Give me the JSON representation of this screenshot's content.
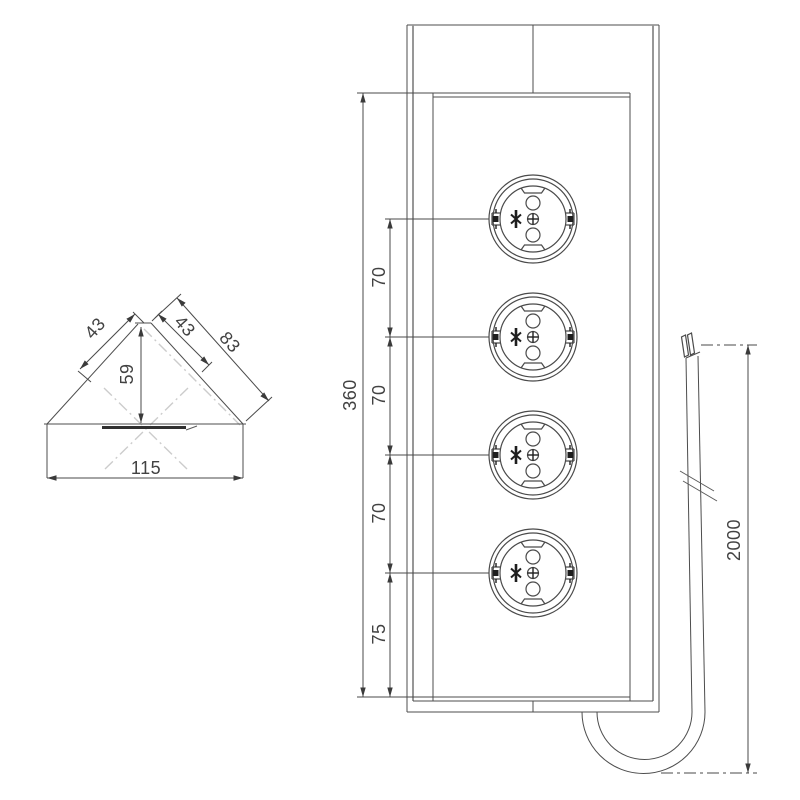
{
  "title": "Corner socket tower - dimensional drawing",
  "dimensions": {
    "corner_view": {
      "left_face": "43",
      "front_upper": "43",
      "front_full": "83",
      "height": "59",
      "base_width": "115"
    },
    "front_view": {
      "height": "360",
      "gap1": "70",
      "gap2": "70",
      "gap3": "70",
      "bottom": "75"
    },
    "cable": {
      "length": "2000"
    }
  },
  "sockets": {
    "count": 4,
    "icon": "schuko-socket-icon"
  },
  "colors": {
    "line": "#4d4d4d",
    "secondary_line": "#979797",
    "centerline": "#cccccc",
    "text": "#424242",
    "background": "#ffffff"
  }
}
